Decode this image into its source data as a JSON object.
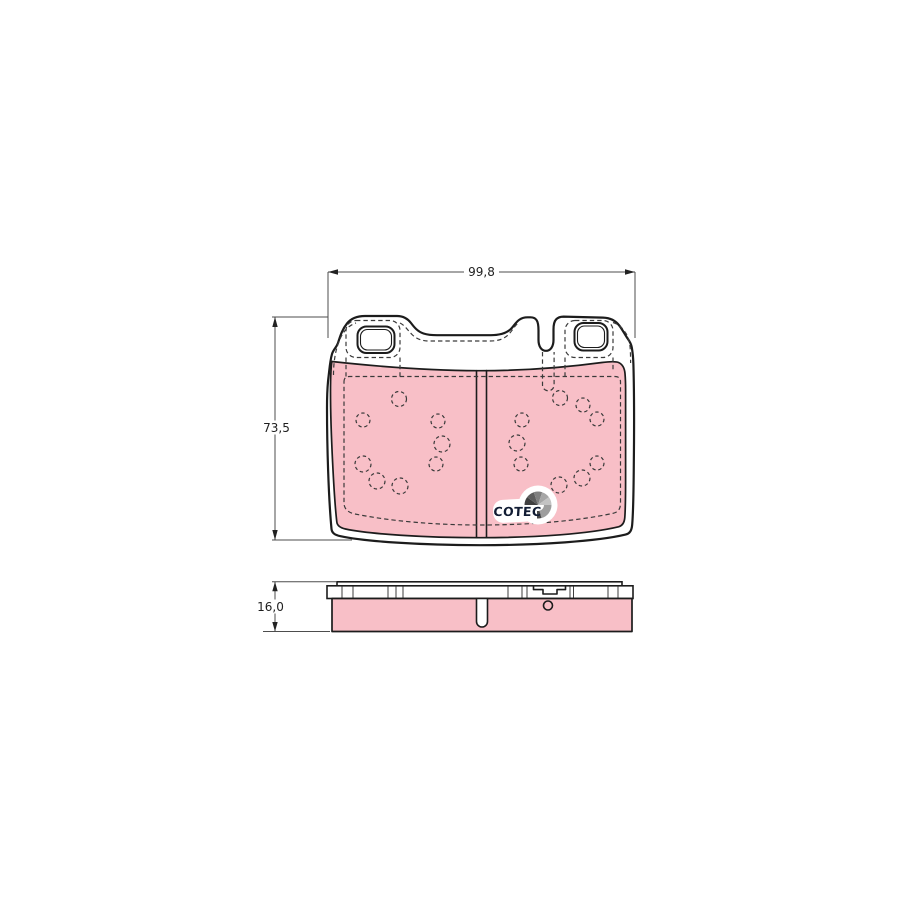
{
  "document": {
    "type": "technical drawing",
    "subject": "disc brake pad set, front view and side profile"
  },
  "views": {
    "front": {
      "width_dim": "99,8",
      "height_dim": "73,5"
    },
    "side": {
      "thickness_dim": "16,0"
    }
  },
  "logo": {
    "text": "COTEC"
  },
  "colors": {
    "friction_fill": "#f8bfc7",
    "outline": "#1c1c1c",
    "dimension_line": "#4d4d4d",
    "logo_text": "#111c33",
    "background": "#ffffff"
  }
}
